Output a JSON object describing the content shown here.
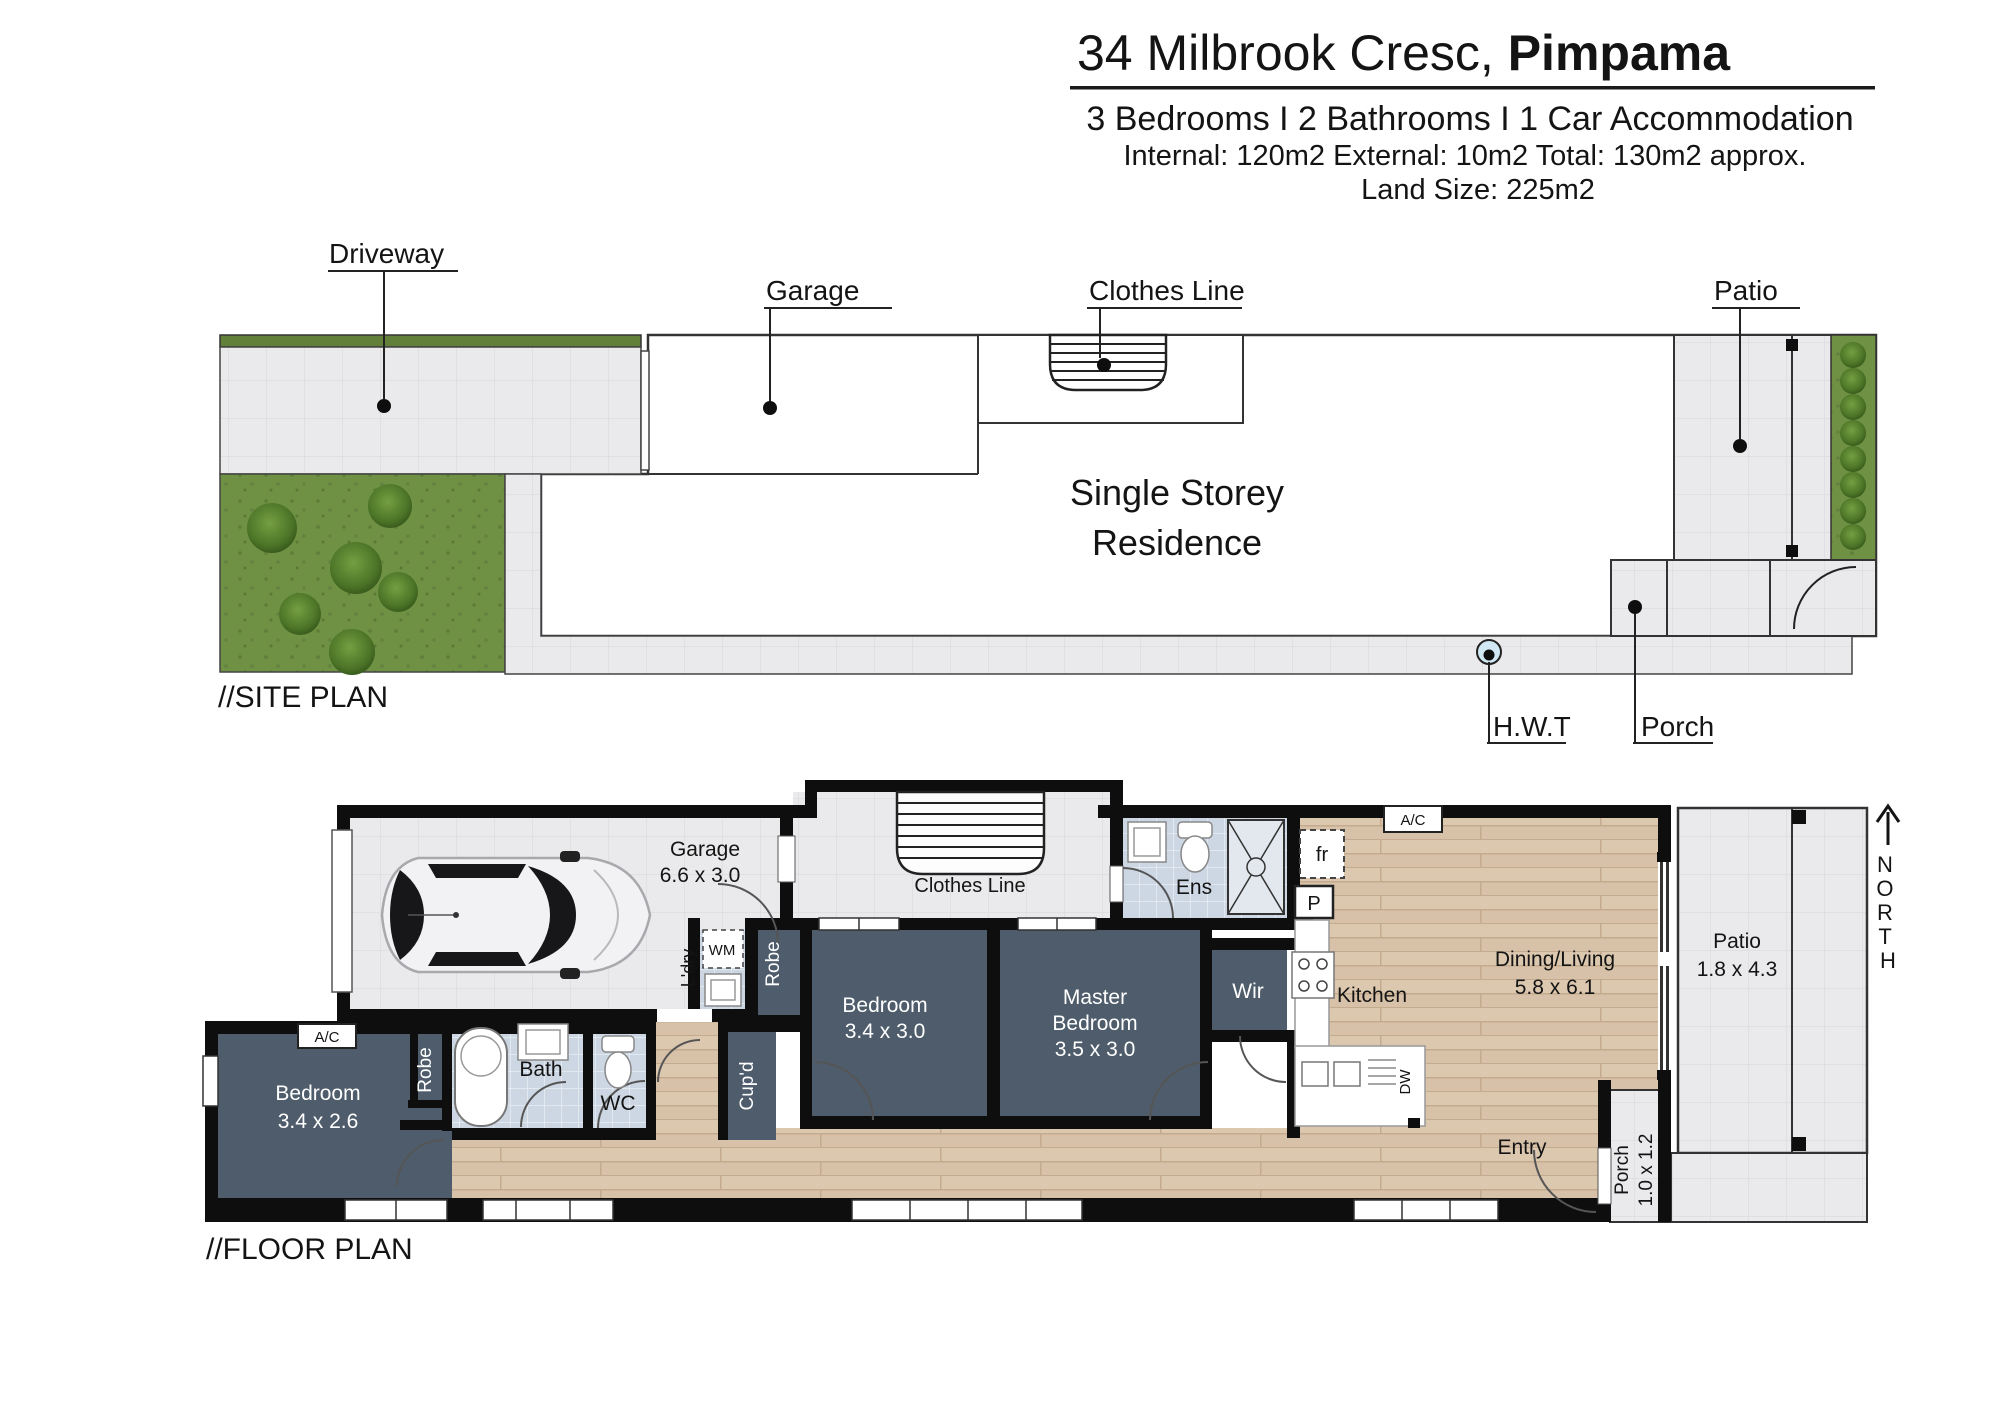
{
  "header": {
    "title_prefix": "34 Milbrook Cresc, ",
    "title_suffix": "Pimpama",
    "specs": "3 Bedrooms I 2 Bathrooms I 1 Car Accommodation",
    "areas": "Internal: 120m2 External: 10m2 Total: 130m2 approx.",
    "land_size": "Land Size: 225m2"
  },
  "site_plan": {
    "section_label": "//SITE PLAN",
    "residence_line1": "Single Storey",
    "residence_line2": "Residence",
    "callouts": {
      "driveway": "Driveway",
      "garage": "Garage",
      "clothes_line": "Clothes Line",
      "patio": "Patio",
      "hwt": "H.W.T",
      "porch": "Porch"
    }
  },
  "floor_plan": {
    "section_label": "//FLOOR PLAN",
    "north_letters": [
      "N",
      "O",
      "R",
      "T",
      "H"
    ],
    "rooms": {
      "garage": {
        "name": "Garage",
        "dims": "6.6 x 3.0"
      },
      "clothes_line": {
        "name": "Clothes Line"
      },
      "laundry": {
        "name": "L'dry"
      },
      "wm": {
        "name": "WM"
      },
      "robe_hall": {
        "name": "Robe"
      },
      "ens": {
        "name": "Ens"
      },
      "bedroom2": {
        "name": "Bedroom",
        "dims": "3.4 x 3.0"
      },
      "master": {
        "line1": "Master",
        "line2": "Bedroom",
        "dims": "3.5 x 3.0"
      },
      "wir": {
        "name": "Wir"
      },
      "kitchen": {
        "name": "Kitchen"
      },
      "dining": {
        "name": "Dining/Living",
        "dims": "5.8 x 6.1"
      },
      "patio": {
        "name": "Patio",
        "dims": "1.8 x 4.3"
      },
      "entry": {
        "name": "Entry"
      },
      "porch": {
        "name": "Porch",
        "dims": "1.0 x 1.2"
      },
      "bedroom3": {
        "name": "Bedroom",
        "dims": "3.4 x 2.6"
      },
      "robe_bed3": {
        "name": "Robe"
      },
      "bath": {
        "name": "Bath"
      },
      "wc": {
        "name": "WC"
      },
      "cupboard": {
        "name": "Cup'd"
      },
      "fridge": {
        "name": "fr"
      },
      "pantry": {
        "name": "P"
      },
      "dishwasher": {
        "name": "DW"
      },
      "ac_bed3": {
        "name": "A/C"
      },
      "ac_dining": {
        "name": "A/C"
      }
    }
  },
  "colors": {
    "wall": "#0e0e0e",
    "bedroom_fill": "#4e5c6b",
    "wood_floor": "#d7c1a8",
    "tile_gray": "#eaeaec",
    "tile_blue": "#cdd6e3",
    "grass": "#6e9143",
    "hedge": "#62803a",
    "hwt_blue": "#cfe8f4"
  }
}
